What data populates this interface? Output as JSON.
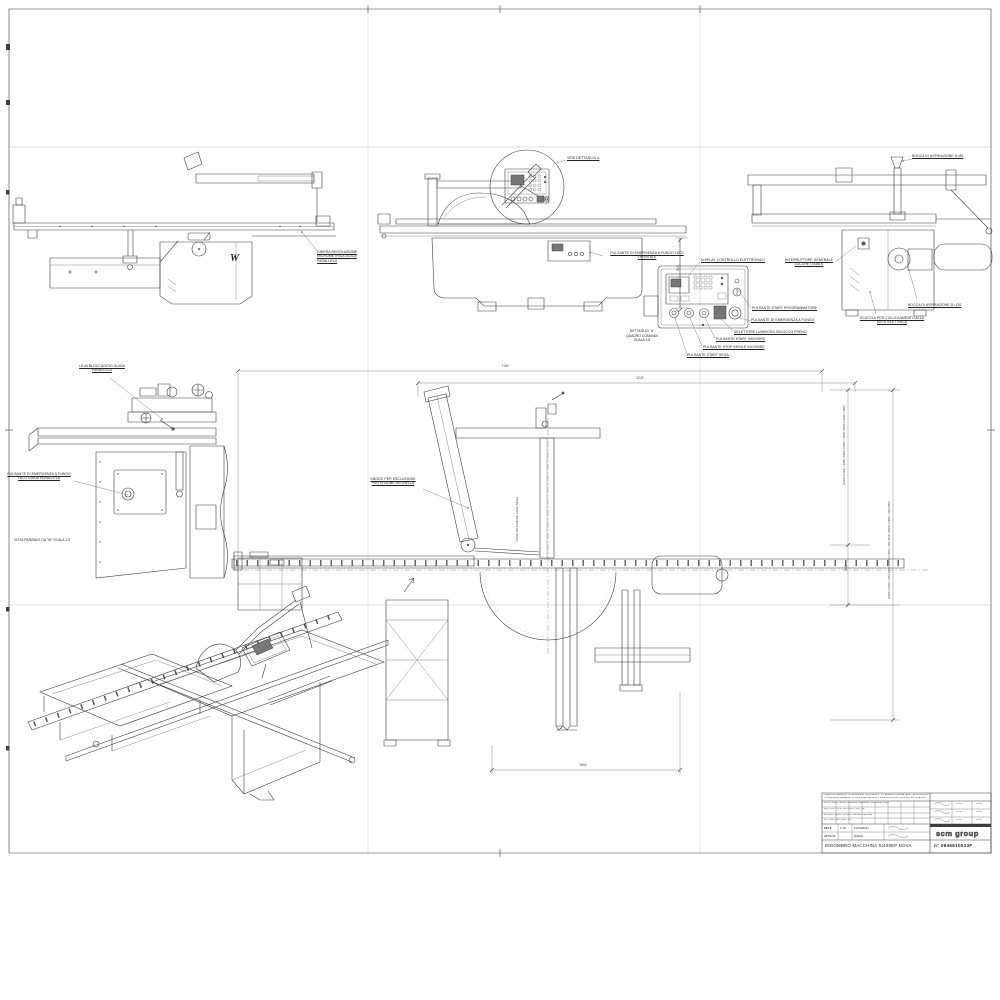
{
  "side_view": {
    "marker": "W",
    "ring_label": "GHIERA REGOLAZIONE MICROMETRICA GUIDA PARALLELA"
  },
  "front_view": {
    "see_detail": "VEDI DETTAGLIO A",
    "emergency": "PULSANTE DI EMERGENZA A FUNGO LATO FRONTALE",
    "height_dim": "910"
  },
  "rear_view": {
    "suction_80": "BOCCA DI ASPIRAZIONE D=80",
    "main_switch": "INTERRUTTORE GENERALE LUCCHETTABILE",
    "suction_120": "BOCCA DI ASPIRAZIONE D=120",
    "electric_box": "SCATOLA PER COLLEGAMENTO ALLA RETE ELETTRICA"
  },
  "detail_a": {
    "caption": "DETTAGLIO \"A\" QUADRO COMANDI SCALA 1:5",
    "display": "DISPLAY CONTROLLO ELETTRONICO",
    "start_programmer": "PULSANTE START PROGRAMMATORE",
    "emergency": "PULSANTE DI EMERGENZA A FUNGO",
    "brake_selector": "SELETTORE LUMINOSO SBLOCCO FRENO",
    "start_scorer": "PULSANTE START INCISORE",
    "stop_saw_scorer": "PULSANTE STOP SEGA E INCISORE",
    "start_saw": "PULSANTE START SEGA"
  },
  "partial_view": {
    "lock_lever": "LEVA BLOCCAGGIO GUIDA PARALLELA",
    "emergency": "PULSANTE DI EMERGENZA A FUNGO LATO GUIDA PARALLELA",
    "caption": "VISTA PARZIALE DA \"W\" SCALA 1:5"
  },
  "plan_view": {
    "dim_total": "7180",
    "dim_partial": "3240",
    "dim_bottom": "2860",
    "dim_side": "368",
    "table_note_1": "(TAVOLO 3200 = 3265) (TAVOLO 3600 = 3665) (TAVOLO 3800 = 3865)",
    "table_note_2": "(TAVOLO 3200 = MAX 4250) (TAVOLO 3600 = MAX 5150) (TAVOLO 3800 = MAX 5950)",
    "joint_label": "SNODO PER ESCLUSIONE PROTEZIONE SEGHELLA",
    "axis_label": "ASSE ROTAZIONE LAMA SEGA"
  },
  "title_block": {
    "property_note": "QUESTO DISEGNO E' DI PROPRIETA' SCM GROUP - A TERMINI DI LEGGE NE E' VIETATA LA RIPRODUZIONE O LA CONSEGNA A TERZI",
    "tolerance_note": "TOLLERANZE GENERALI DI LAVORAZIONE SALVO INDICAZIONI PARTICOLARI SUL DISEGNO",
    "tol_ranges": "0.5÷6 | 6÷30 | 30÷120 | 120÷400 | 400÷1000 | 1000÷2000 | oltre",
    "tol_values": "±0.1 | ±0.2 | ±0.3 | ±0.5 | ±0.8 | ±1.2 | ±2",
    "tol_ranges2": "fino a 10 | 10÷50 | 50÷120 | 120÷400 | oltre 400",
    "tol_values2": "±1° | ±30' | ±20' | ±10' | ±5'",
    "format": "CFI 0",
    "scale_value": "1:10",
    "drawn_by": "FUSAROLI",
    "date": "25/01/11",
    "checked_by": "NADIA",
    "company": "scm group",
    "title": "INGOMBRO MACCHINA SI400EP NOVA",
    "number": "n° 0946610033F"
  }
}
